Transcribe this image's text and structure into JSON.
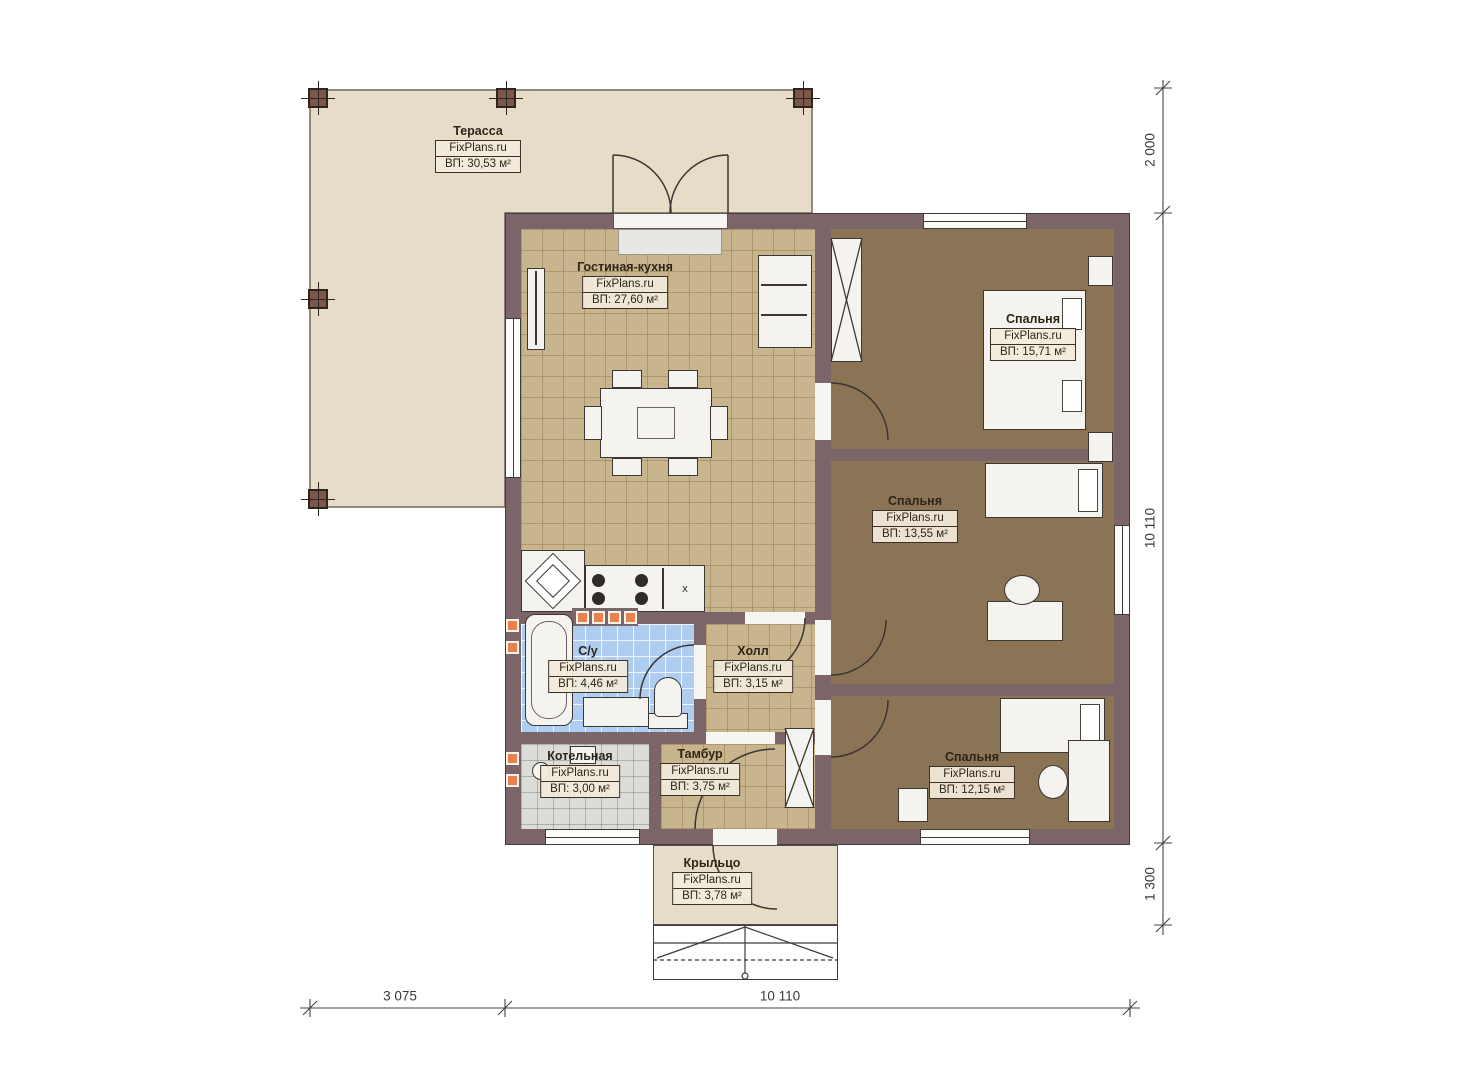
{
  "rooms": {
    "terrace": {
      "name": "Терасса",
      "brand": "FixPlans.ru",
      "area": "ВП: 30,53 м²"
    },
    "living": {
      "name": "Гостиная-кухня",
      "brand": "FixPlans.ru",
      "area": "ВП: 27,60 м²"
    },
    "bedroom1": {
      "name": "Спальня",
      "brand": "FixPlans.ru",
      "area": "ВП: 15,71 м²"
    },
    "bedroom2": {
      "name": "Спальня",
      "brand": "FixPlans.ru",
      "area": "ВП: 13,55 м²"
    },
    "bedroom3": {
      "name": "Спальня",
      "brand": "FixPlans.ru",
      "area": "ВП: 12,15 м²"
    },
    "bathroom": {
      "name": "С/у",
      "brand": "FixPlans.ru",
      "area": "ВП: 4,46 м²"
    },
    "hall": {
      "name": "Холл",
      "brand": "FixPlans.ru",
      "area": "ВП: 3,15 м²"
    },
    "boiler": {
      "name": "Котельная",
      "brand": "FixPlans.ru",
      "area": "ВП: 3,00 м²"
    },
    "vestibule": {
      "name": "Тамбур",
      "brand": "FixPlans.ru",
      "area": "ВП: 3,75 м²"
    },
    "porch": {
      "name": "Крыльцо",
      "brand": "FixPlans.ru",
      "area": "ВП: 3,78 м²"
    }
  },
  "dimensions": {
    "right_top": "2 000",
    "right_middle": "10 110",
    "right_bottom": "1 300",
    "bottom_left": "3 075",
    "bottom_right": "10 110"
  },
  "kitchen": {
    "appliance_mark": "x"
  },
  "colors": {
    "wall": "#7c6568",
    "terrace": "#e6dcc8",
    "living_floor": "#c9b58d",
    "bedroom_floor": "#8b7456",
    "bathroom_floor": "#aecdf0",
    "boiler_floor": "#dcdcd8",
    "radiator": "#e8824d"
  }
}
